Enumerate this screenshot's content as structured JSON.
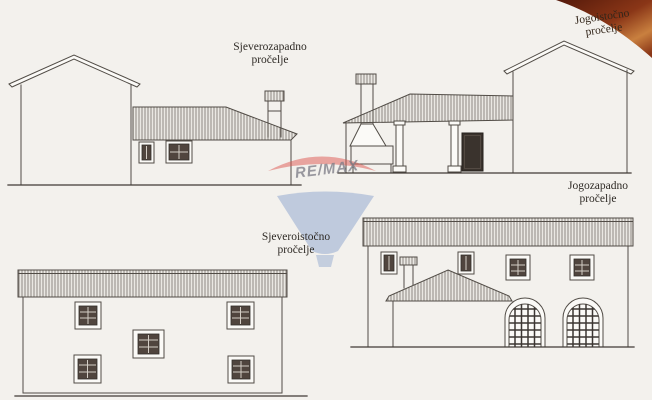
{
  "canvas": {
    "background": "#f3f1ed",
    "ink": "#514c46"
  },
  "labels": {
    "northwest": {
      "line1": "Sjeverozapadno",
      "line2": "pročelje"
    },
    "southeast": {
      "line1": "Jogoistočno",
      "line2": "pročelje"
    },
    "northeast": {
      "line1": "Sjeveroistočno",
      "line2": "pročelje"
    },
    "southwest": {
      "line1": "Jogozapadno",
      "line2": "pročelje"
    }
  },
  "watermark": {
    "brand": "RE/MAX",
    "balloon_red": "#dd5550",
    "balloon_blue": "#8ba4cd",
    "text_gray": "#8f8f97"
  },
  "decoration": {
    "corner_dark": "#54190a",
    "corner_mid": "#8a3617",
    "corner_light": "#c9803f"
  }
}
